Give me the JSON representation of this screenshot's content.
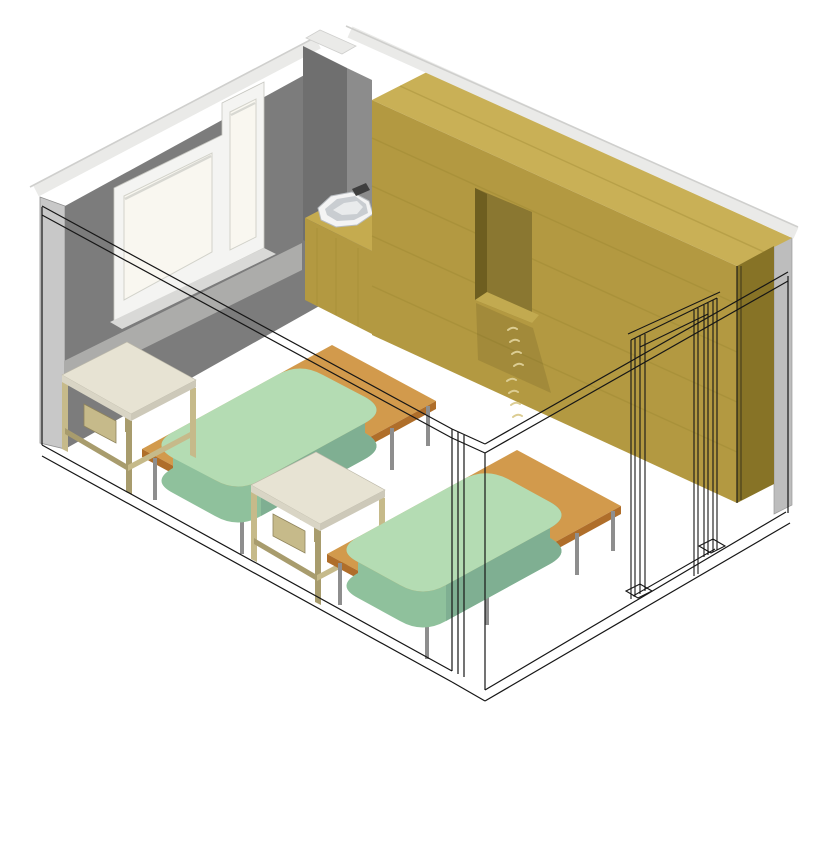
{
  "view": {
    "title": "3D axonometric room interior rendering",
    "projection": "axonometric",
    "width": 820,
    "height": 847,
    "background": "#FFFFFF"
  },
  "scene": {
    "objects": [
      {
        "name": "left-wall",
        "label": "gray wall with window"
      },
      {
        "name": "window",
        "label": "two-pane window, tall narrow right light"
      },
      {
        "name": "window-apron",
        "label": "light band below window sill"
      },
      {
        "name": "back-right-wall",
        "label": "gray wall behind wardrobe"
      },
      {
        "name": "wardrobe",
        "label": "full-height wood wardrobe wall unit"
      },
      {
        "name": "niche",
        "label": "recessed open niche in wardrobe"
      },
      {
        "name": "drawer-pulls",
        "label": "column of small drawer handles"
      },
      {
        "name": "washbasin-counter",
        "label": "wood counter with white corner basin and faucet"
      },
      {
        "name": "door-frame",
        "label": "wireframe door opening at right"
      },
      {
        "name": "bed-1",
        "label": "platform bed with green mattress (rear)"
      },
      {
        "name": "bed-2",
        "label": "platform bed with green mattress (front)"
      },
      {
        "name": "table-1",
        "label": "side table near window"
      },
      {
        "name": "table-2",
        "label": "side table between beds"
      },
      {
        "name": "cutaway-outline",
        "label": "black wireframe of removed front walls"
      }
    ]
  },
  "colors": {
    "background": "#FFFFFF",
    "line": "#161616",
    "wallDark": "#7C7C7C",
    "wallMid": "#8C8C8C",
    "pillarDark": "#6F6F6F",
    "wallLight": "#BDBDBD",
    "wallEdge": "#C8C8C8",
    "wallCap": "#EAEAE8",
    "capShade": "#CFCFCD",
    "windowFrame": "#F4F4F2",
    "glass": "#F9F7F0",
    "paneShade": "#D8D8D2",
    "sill": "#D9D9D7",
    "apron": "#ACACAA",
    "woodFront": "#B39941",
    "woodTop": "#C9B056",
    "woodSide": "#877326",
    "woodGrain": "#99832F",
    "nicheBack": "#8A7731",
    "nicheSide": "#6E5E20",
    "nicheSill": "#C2AA50",
    "nicheShadow": "#5F511C",
    "pull": "#DCCD93",
    "counterTop": "#C5AB4F",
    "basinWhite": "#F4F4F4",
    "basinShade": "#C9CDD1",
    "basinDeep": "#E9EBEC",
    "faucet": "#3F3F3F",
    "mattressTop": "#B4DCB3",
    "mattressSide": "#8FC19C",
    "mattressDark": "#7FAF92",
    "bedWoodTop": "#D29A4C",
    "bedWoodFront": "#AF6E2A",
    "bedLeg": "#8E8E8E",
    "tableTop": "#E7E3D3",
    "tableEdgeL": "#D9D5C5",
    "tableEdgeR": "#CDC9B9",
    "tableLegLight": "#C6BA8A",
    "tableLegDark": "#A89C6D"
  }
}
